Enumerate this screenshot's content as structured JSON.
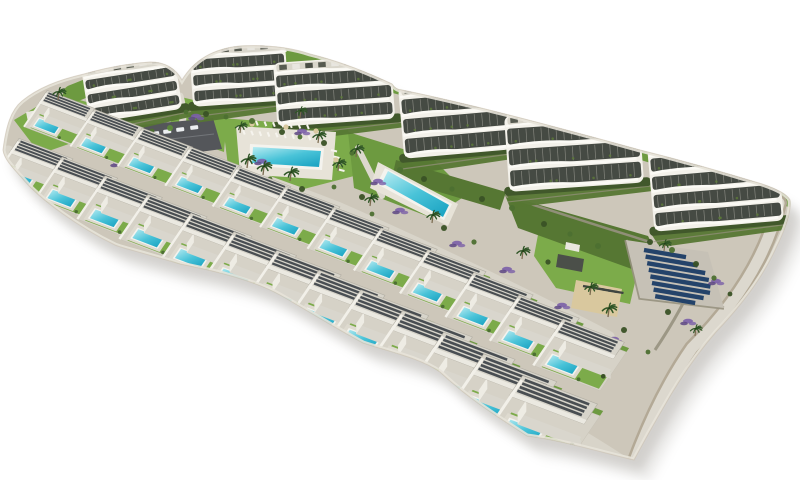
{
  "meta": {
    "description": "Aerial 3D architectural render of a coastal residential development: an arc of six white curved apartment buildings above two cascading rows of white villas with private turquoise pools, communal pools, parking lot, lawns, palm trees, lavender beds and a solar panel field, isolated on a white background"
  },
  "palette": {
    "bg": "#ffffff",
    "ground": "#cdc7ba",
    "shadow": "#8c8880",
    "grass_bright": "#7cab4a",
    "grass_mid": "#6d9a40",
    "grass_dark": "#567733",
    "road": "#d8d4c9",
    "path_light": "#dcd8ce",
    "path_border": "#b3a996",
    "building_white": "#f3f1ea",
    "building_band": "#454a43",
    "building_roof": "#d9d6cb",
    "parapet": "#fbfaf5",
    "villa_pad": "#d6d2c7",
    "villa_deck": "#dedacf",
    "villa_wall_front": "#d9d6cd",
    "villa_wall_side": "#eeece4",
    "villa_roof": "#d7d4ca",
    "villa_slat": "#3a4046",
    "divider": "#f2f0e9",
    "pool_rim": "#f4f3ee",
    "pool_light": "#b9ecf2",
    "pool_mid": "#49c3d8",
    "pool_deep": "#1fa6c4",
    "parking": "#54565a",
    "car_light": "#eceff1",
    "car_gray": "#b9bec4",
    "solar_pad": "#c6c1b6",
    "solar_panel": "#24436a",
    "sand": "#d9c89e",
    "lounger_dark": "#3f4540",
    "lavender": "#7b5fa8",
    "lavender_dark": "#5d4684",
    "wall_stone": "#97917f",
    "palm_leaf": "#2f5526",
    "palm_trunk": "#7a6a4e",
    "bush_greens": [
      "#3a5226",
      "#4d7032",
      "#5e8a3c"
    ]
  },
  "scene": {
    "island_path": "M3,150 C6,126 11,110 22,101 C38,88 58,80 84,74 Q120,64 150,62 Q172,62 182,80 Q200,50 240,46 Q280,44 310,54 Q350,64 392,84 Q396,90 402,90 Q450,100 505,114 Q560,128 640,150 Q700,165 762,184 Q786,192 790,200 Q792,216 776,248 Q758,288 716,332 Q688,364 662,410 Q648,434 634,460 C600,452 560,440 527,436 C495,415 470,400 440,372 C420,358 390,352 363,343 C330,325 303,308 280,295 C250,278 200,268 180,264 C140,252 122,248 115,245 C80,228 40,200 22,178 C10,165 4,158 3,150 Z",
    "green_zones": [
      {
        "pts": [
          [
            222,
            118
          ],
          [
            348,
            128
          ],
          [
            354,
            176
          ],
          [
            300,
            190
          ],
          [
            228,
            166
          ]
        ],
        "c": "grass_bright"
      },
      {
        "pts": [
          [
            348,
            132
          ],
          [
            432,
            158
          ],
          [
            468,
            194
          ],
          [
            432,
            218
          ],
          [
            354,
            188
          ]
        ],
        "c": "grass_mid"
      },
      {
        "pts": [
          [
            540,
            224
          ],
          [
            642,
            252
          ],
          [
            630,
            304
          ],
          [
            556,
            288
          ],
          [
            534,
            256
          ]
        ],
        "c": "grass_bright"
      },
      {
        "pts": [
          [
            14,
            120
          ],
          [
            58,
            94
          ],
          [
            94,
            104
          ],
          [
            86,
            138
          ],
          [
            40,
            154
          ]
        ],
        "c": "grass_bright"
      },
      {
        "pts": [
          [
            168,
            94
          ],
          [
            228,
            108
          ],
          [
            224,
            152
          ],
          [
            172,
            134
          ]
        ],
        "c": "grass_bright"
      },
      {
        "pts": [
          [
            505,
            195
          ],
          [
            648,
            236
          ],
          [
            662,
            264
          ],
          [
            640,
            272
          ],
          [
            518,
            228
          ]
        ],
        "c": "grass_dark"
      },
      {
        "pts": [
          [
            396,
            160
          ],
          [
            506,
            192
          ],
          [
            500,
            210
          ],
          [
            392,
            178
          ]
        ],
        "c": "grass_dark"
      }
    ],
    "roads": [
      {
        "d": "M72,94 C130,70 190,48 280,56 Q395,84 505,112 Q640,148 790,198",
        "c": "grass_mid",
        "w": 18
      },
      {
        "d": "M70,122 Q200,152 340,207 Q470,264 610,336",
        "c": "road",
        "w": 9
      },
      {
        "d": "M8,152 Q250,262 520,402 Q570,428 622,462",
        "c": "road",
        "w": 13
      },
      {
        "d": "M779,203 Q762,278 692,348 Q660,394 636,458",
        "c": "path_border",
        "w": 16
      },
      {
        "d": "M779,203 Q762,278 692,348 Q660,394 636,458",
        "c": "path_light",
        "w": 11
      },
      {
        "d": "M358,148 Q370,172 382,196",
        "c": "path_light",
        "w": 6
      },
      {
        "d": "M180,96 Q186,116 180,134",
        "c": "path_light",
        "w": 7
      }
    ],
    "walls": [
      {
        "d": "M626,240 L640,298 L724,308",
        "w": 3.5
      },
      {
        "d": "M700,268 Q682,310 655,350",
        "w": 3
      },
      {
        "d": "M506,196 Q580,220 650,242",
        "w": 2.5
      }
    ],
    "parking": {
      "pts": [
        [
          120,
          127
        ],
        [
          213,
          118
        ],
        [
          222,
          149
        ],
        [
          131,
          161
        ]
      ],
      "lane": "M128,144 L214,134",
      "cars_light": [
        [
          139,
          134
        ],
        [
          151,
          132
        ],
        [
          163,
          130
        ],
        [
          176,
          128
        ],
        [
          190,
          126
        ]
      ],
      "cars_gray": [
        [
          147,
          149
        ],
        [
          161,
          147
        ]
      ]
    },
    "buildings": [
      {
        "x": 81,
        "y": 68,
        "w": 94,
        "h": 56,
        "rot": -9,
        "floors": 3
      },
      {
        "x": 189,
        "y": 47,
        "w": 96,
        "h": 60,
        "rot": -4,
        "floors": 3
      },
      {
        "x": 273,
        "y": 63,
        "w": 118,
        "h": 64,
        "rot": -4,
        "floors": 3
      },
      {
        "x": 398,
        "y": 87,
        "w": 108,
        "h": 72,
        "rot": -5,
        "floors": 3
      },
      {
        "x": 504,
        "y": 116,
        "w": 135,
        "h": 76,
        "rot": -4,
        "floors": 3
      },
      {
        "x": 647,
        "y": 146,
        "w": 130,
        "h": 86,
        "rot": -5,
        "floors": 4
      }
    ],
    "main_pool": {
      "deck": [
        [
          236,
          126
        ],
        [
          336,
          132
        ],
        [
          332,
          180
        ],
        [
          240,
          174
        ]
      ],
      "rim": [
        [
          250,
          144
        ],
        [
          324,
          148
        ],
        [
          322,
          170
        ],
        [
          249,
          166
        ]
      ],
      "water": [
        [
          253,
          147
        ],
        [
          321,
          151
        ],
        [
          319,
          167
        ],
        [
          252,
          163
        ]
      ]
    },
    "lap_pool": {
      "deck": [
        [
          378,
          162
        ],
        [
          458,
          204
        ],
        [
          448,
          226
        ],
        [
          370,
          188
        ]
      ],
      "rim": [
        [
          385,
          168
        ],
        [
          452,
          204
        ],
        [
          444,
          220
        ],
        [
          377,
          184
        ]
      ],
      "water": [
        [
          388,
          171
        ],
        [
          449,
          205
        ],
        [
          443,
          217
        ],
        [
          382,
          183
        ]
      ]
    },
    "loungers": [
      {
        "x": 243,
        "y": 130,
        "n": 10,
        "dx": 8.2,
        "dy": 0.7,
        "ex": 1.8,
        "ey": 4.5
      },
      {
        "x": 256,
        "y": 121,
        "n": 7,
        "dx": 8.5,
        "dy": 0.6,
        "ex": 1.8,
        "ey": 4.5
      },
      {
        "x": 331,
        "y": 150,
        "n": 4,
        "dx": 2.5,
        "dy": 6.5,
        "ex": 6.0,
        "ey": 1.5
      }
    ],
    "umbrellas": [
      [
        252,
        124
      ],
      [
        286,
        127
      ],
      [
        316,
        131
      ],
      [
        336,
        160
      ]
    ],
    "solar": {
      "pad": [
        [
          626,
          240
        ],
        [
          708,
          252
        ],
        [
          724,
          308
        ],
        [
          640,
          298
        ]
      ],
      "x": 644,
      "y": 250,
      "n": 8,
      "dx": 1.6,
      "dy": 6.6,
      "slope": 0.17,
      "lens": [
        42,
        52,
        58,
        60,
        60,
        58,
        50,
        40
      ]
    },
    "sand": {
      "pts": [
        [
          576,
          280
        ],
        [
          622,
          289
        ],
        [
          617,
          317
        ],
        [
          571,
          308
        ]
      ],
      "loungers": {
        "x": 583,
        "y": 286,
        "n": 6,
        "dx": 6.3,
        "dy": 1.1,
        "len": 9
      }
    },
    "pergola": {
      "dark": [
        [
          558,
          254
        ],
        [
          584,
          259
        ],
        [
          582,
          272
        ],
        [
          556,
          267
        ]
      ],
      "light": [
        [
          566,
          242
        ],
        [
          580,
          245
        ],
        [
          579,
          252
        ],
        [
          565,
          249
        ]
      ]
    },
    "patio_left": [
      [
        26,
        112
      ],
      [
        44,
        109
      ],
      [
        46,
        119
      ],
      [
        28,
        122
      ]
    ],
    "villas_back": [
      [
        48,
        99,
        0.83
      ],
      [
        95,
        118,
        0.85
      ],
      [
        143,
        137,
        0.87
      ],
      [
        191,
        156,
        0.89
      ],
      [
        239,
        176,
        0.91
      ],
      [
        287,
        196,
        0.93
      ],
      [
        335,
        217,
        0.95
      ],
      [
        382,
        238,
        0.97
      ],
      [
        429,
        260,
        1.0
      ],
      [
        475,
        283,
        1.02
      ],
      [
        520,
        306,
        1.04
      ],
      [
        564,
        330,
        1.06
      ]
    ],
    "villas_front": [
      [
        20,
        148,
        0.93
      ],
      [
        63,
        167,
        0.96
      ],
      [
        106,
        186,
        0.99
      ],
      [
        149,
        205,
        1.02
      ],
      [
        192,
        224,
        1.05
      ],
      [
        235,
        243,
        1.08
      ],
      [
        278,
        262,
        1.11
      ],
      [
        320,
        282,
        1.14
      ],
      [
        362,
        302,
        1.17
      ],
      [
        404,
        323,
        1.2
      ],
      [
        445,
        345,
        1.23
      ],
      [
        485,
        367,
        1.26
      ],
      [
        524,
        389,
        1.29
      ]
    ],
    "bushes": [
      [
        96,
        130,
        3,
        0
      ],
      [
        114,
        132,
        2.4,
        1
      ],
      [
        132,
        134,
        3,
        0
      ],
      [
        152,
        131,
        2.4,
        1
      ],
      [
        170,
        128,
        3,
        2
      ],
      [
        186,
        112,
        2.4,
        1
      ],
      [
        206,
        114,
        3,
        0
      ],
      [
        226,
        117,
        2.4,
        1
      ],
      [
        252,
        121,
        3,
        1
      ],
      [
        282,
        132,
        3,
        0
      ],
      [
        300,
        137,
        2.4,
        1
      ],
      [
        324,
        143,
        3,
        0
      ],
      [
        352,
        153,
        2.6,
        1
      ],
      [
        400,
        170,
        3,
        1
      ],
      [
        424,
        179,
        3,
        0
      ],
      [
        452,
        189,
        2.6,
        1
      ],
      [
        482,
        199,
        3,
        0
      ],
      [
        512,
        208,
        3,
        1
      ],
      [
        544,
        224,
        3,
        0
      ],
      [
        570,
        234,
        2.6,
        1
      ],
      [
        598,
        246,
        3,
        1
      ],
      [
        650,
        242,
        3,
        0
      ],
      [
        672,
        250,
        3,
        1
      ],
      [
        696,
        264,
        3,
        0
      ],
      [
        714,
        278,
        2.6,
        1
      ],
      [
        730,
        294,
        2.4,
        0
      ],
      [
        238,
        168,
        3,
        0
      ],
      [
        270,
        179,
        2.4,
        1
      ],
      [
        302,
        189,
        3,
        0
      ],
      [
        334,
        187,
        2.4,
        1
      ],
      [
        362,
        197,
        3,
        0
      ],
      [
        372,
        214,
        2.4,
        1
      ],
      [
        444,
        228,
        3,
        0
      ],
      [
        474,
        242,
        2.6,
        1
      ],
      [
        548,
        262,
        2.6,
        0
      ],
      [
        624,
        330,
        3,
        0
      ],
      [
        648,
        352,
        2.4,
        1
      ],
      [
        668,
        312,
        3,
        0
      ]
    ],
    "palms": [
      [
        58,
        100,
        1
      ],
      [
        240,
        133,
        0.9
      ],
      [
        247,
        168,
        1.1
      ],
      [
        263,
        175,
        1.1
      ],
      [
        290,
        181,
        1.1
      ],
      [
        318,
        143,
        1
      ],
      [
        338,
        171,
        1
      ],
      [
        300,
        118,
        0.9
      ],
      [
        356,
        157,
        1
      ],
      [
        370,
        206,
        1
      ],
      [
        432,
        223,
        1
      ],
      [
        522,
        259,
        1
      ],
      [
        608,
        317,
        1.1
      ],
      [
        664,
        251,
        0.9
      ],
      [
        590,
        295,
        1
      ],
      [
        695,
        336,
        0.9
      ]
    ],
    "lavender": [
      [
        196,
        116
      ],
      [
        302,
        131
      ],
      [
        118,
        163
      ],
      [
        86,
        139
      ],
      [
        344,
        223
      ],
      [
        378,
        181
      ],
      [
        457,
        243
      ],
      [
        507,
        269
      ],
      [
        562,
        305
      ],
      [
        614,
        339
      ],
      [
        688,
        321
      ],
      [
        716,
        281
      ],
      [
        400,
        210
      ],
      [
        262,
        161
      ]
    ]
  }
}
